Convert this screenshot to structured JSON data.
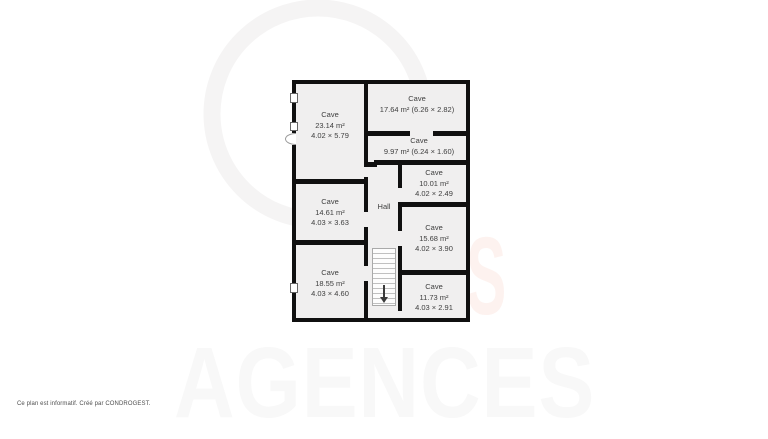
{
  "plan": {
    "hall_label": "Hall",
    "rooms": [
      {
        "name": "Cave",
        "area": "23.14 m²",
        "dims": "4.02 × 5.79"
      },
      {
        "name": "Cave",
        "area": "17.64 m² (6.26 × 2.82)",
        "dims": ""
      },
      {
        "name": "Cave",
        "area": "9.97 m² (6.24 × 1.60)",
        "dims": ""
      },
      {
        "name": "Cave",
        "area": "10.01 m²",
        "dims": "4.02 × 2.49"
      },
      {
        "name": "Cave",
        "area": "14.61 m²",
        "dims": "4.03 × 3.63"
      },
      {
        "name": "Cave",
        "area": "15.68 m²",
        "dims": "4.02 × 3.90"
      },
      {
        "name": "Cave",
        "area": "18.55 m²",
        "dims": "4.03 × 4.60"
      },
      {
        "name": "Cave",
        "area": "11.73 m²",
        "dims": "4.03 × 2.91"
      }
    ]
  },
  "watermark": {
    "brand_text": "AGENCES",
    "letter": "S"
  },
  "footer": {
    "disclaimer": "Ce plan est informatif. Créé par CONDROGEST."
  },
  "colors": {
    "wall": "#101010",
    "room_fill": "#f0efef",
    "label_text": "#3e3e3e",
    "watermark_gray": "#f8f8f8",
    "watermark_ring": "#f5f4f4",
    "watermark_pink": "rgba(240,125,95,0.10)"
  }
}
